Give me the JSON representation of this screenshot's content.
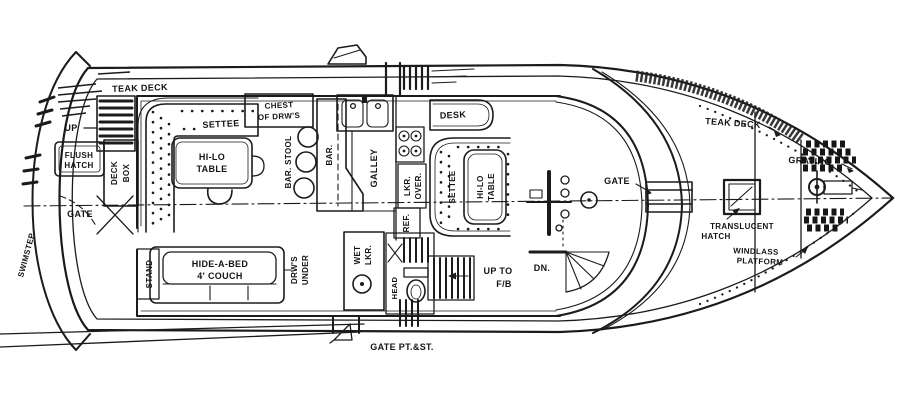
{
  "colors": {
    "ink": "#1b1b1b",
    "paper": "#ffffff"
  },
  "labels": {
    "teak_deck_aft": "TEAK DECK",
    "up_aft": "UP",
    "flush_hatch_1": "FLUSH",
    "flush_hatch_2": "HATCH",
    "deck_box_1": "DECK",
    "deck_box_2": "BOX",
    "gate_aft": "GATE",
    "swimstep": "SWIMSTEP",
    "settee_port": "SETTEE",
    "hilo_port_1": "HI-LO",
    "hilo_port_2": "TABLE",
    "chest_1": "CHEST",
    "chest_2": "OF DRW'S",
    "bar_stool": "BAR. STOOL",
    "bar": "BAR.",
    "galley": "GALLEY",
    "lkr_over_1": "LKR.",
    "lkr_over_2": "OVER.",
    "ref": "REF.",
    "desk": "DESK",
    "settee_stbd": "SETTEE",
    "hilo_stbd_1": "HI-LO",
    "hilo_stbd_2": "TABLE",
    "gate_fwd": "GATE",
    "dn": "DN.",
    "up_to_fb_1": "UP TO",
    "up_to_fb_2": "F/B",
    "head": "HEAD",
    "wet_lkr_1": "WET",
    "wet_lkr_2": "LKR.",
    "drws_under_1": "DRW'S",
    "drws_under_2": "UNDER",
    "hide_a_bed_1": "HIDE-A-BED",
    "hide_a_bed_2": "4' COUCH",
    "stand": "STAND",
    "gate_pt_st": "GATE PT.&ST.",
    "teak_deck_fwd": "TEAK DECK",
    "grating": "GRATING",
    "translucent_1": "TRANSLUCENT",
    "translucent_2": "HATCH",
    "windlass_1": "WINDLASS",
    "windlass_2": "PLATFORM"
  }
}
